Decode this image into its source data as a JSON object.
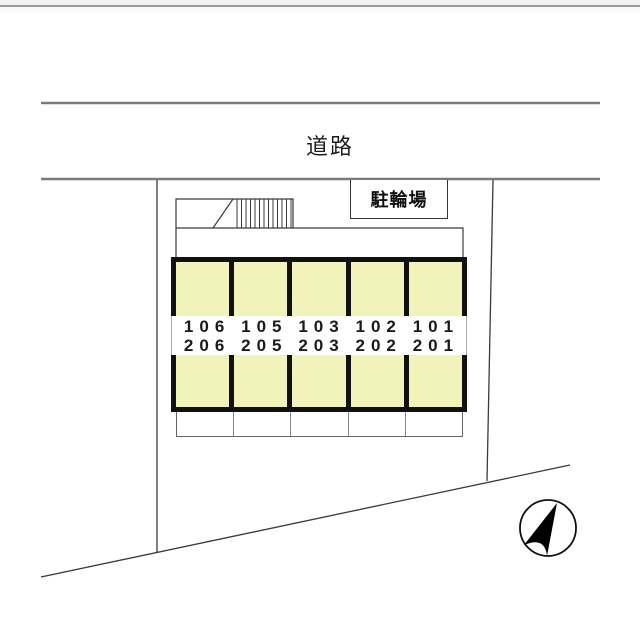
{
  "labels": {
    "road": "道路",
    "bicycle_parking": "駐輪場"
  },
  "building": {
    "floors": 2,
    "units_row1": [
      "106",
      "105",
      "103",
      "102",
      "101"
    ],
    "units_row2": [
      "206",
      "205",
      "203",
      "202",
      "201"
    ]
  },
  "compass": {
    "icon": "north-arrow"
  },
  "colors": {
    "room_fill": "#f1f3ba",
    "building_outline": "#111111",
    "road_line": "#7b7b7b",
    "boundary_line": "#3a3a3a",
    "background": "#ffffff"
  }
}
